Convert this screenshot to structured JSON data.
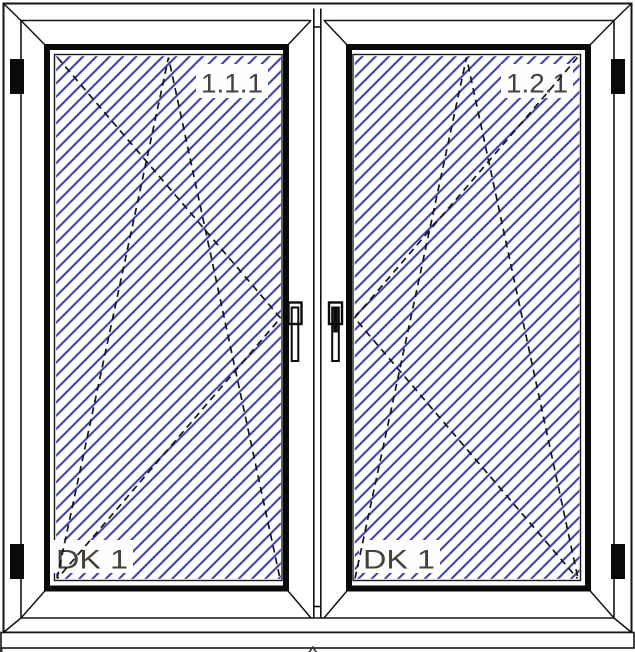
{
  "drawing": {
    "kind": "window-elevation-technical-drawing",
    "colors": {
      "background": "#ffffff",
      "line": "#141414",
      "glass_hatch": "#3737ab",
      "label_text": "#454039",
      "label_halo": "#fdfdfd",
      "hardware_fill": "#0a0a0a"
    },
    "panels": [
      {
        "position_label": "1.1.1",
        "opening_label": "DK 1",
        "opening_symbol": "tilt-turn-dashed-triangles",
        "hinge_side": "left",
        "handle_side": "right"
      },
      {
        "position_label": "1.2.1",
        "opening_label": "DK 1",
        "opening_symbol": "tilt-turn-dashed-triangles",
        "hinge_side": "right",
        "handle_side": "left"
      }
    ],
    "hardware": {
      "hinge_count": 4,
      "handle_count": 2
    }
  }
}
